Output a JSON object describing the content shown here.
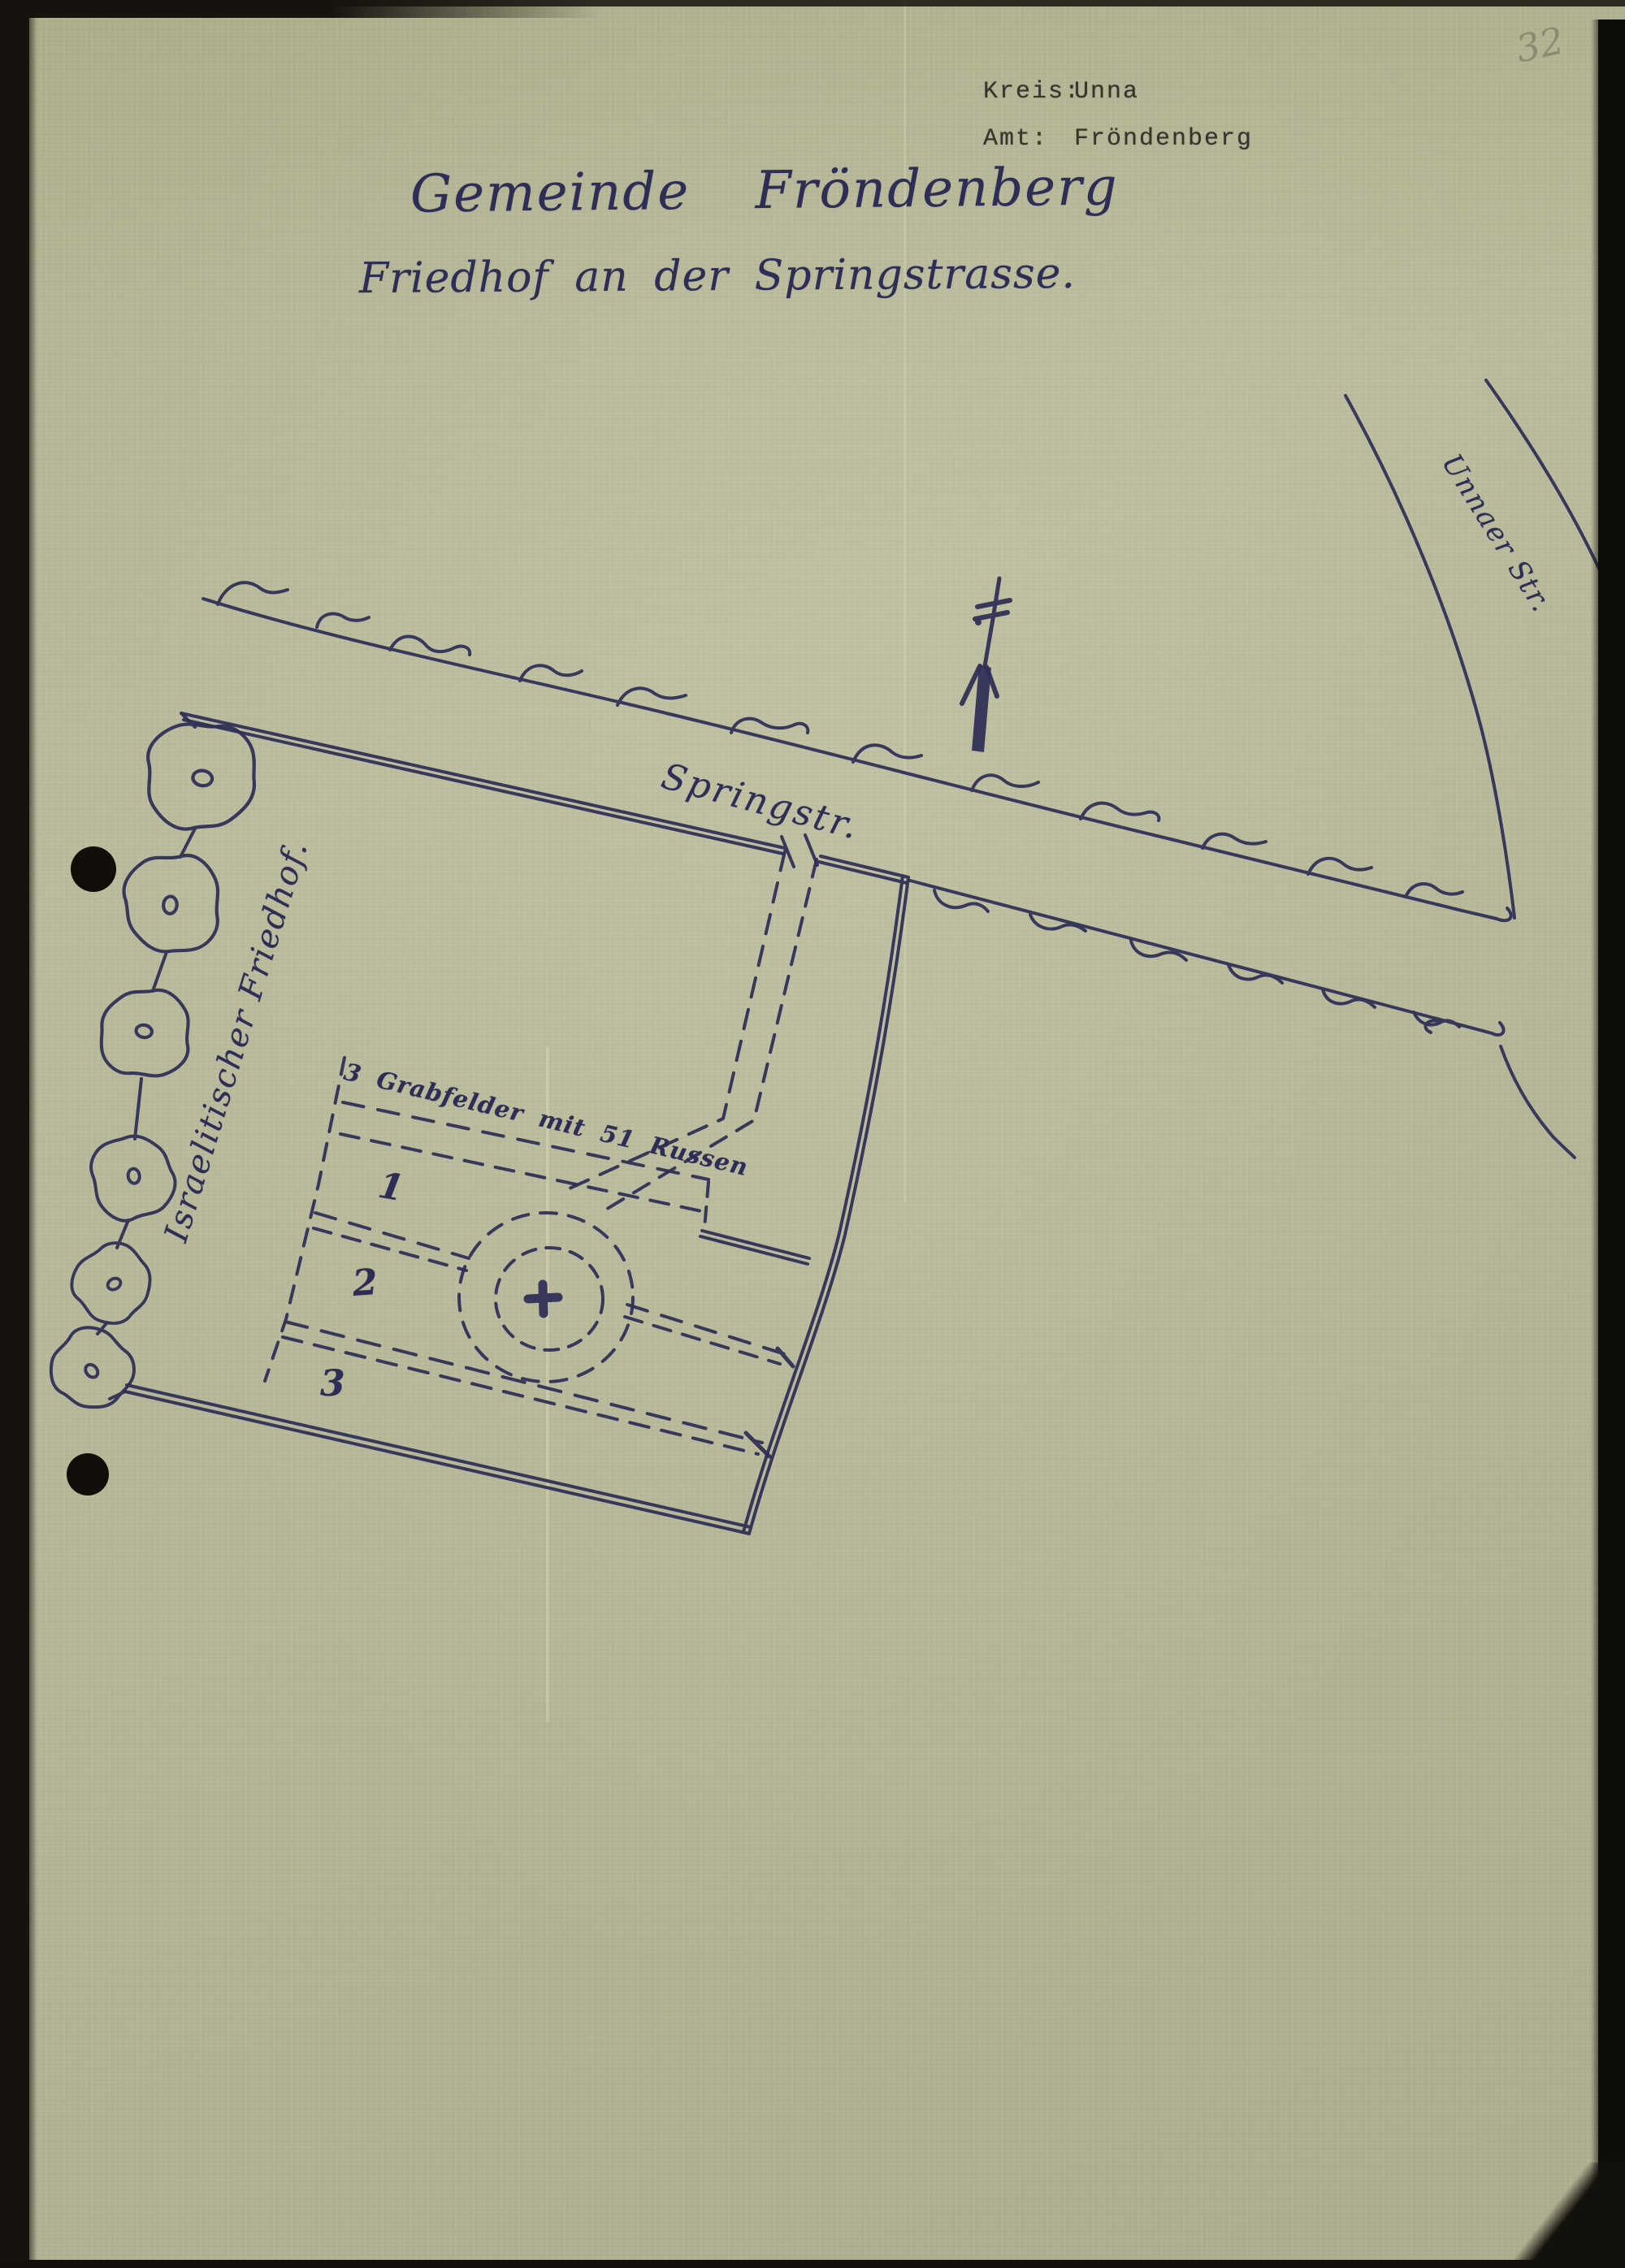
{
  "page": {
    "corner_number": "32",
    "header": {
      "rows": [
        {
          "label": "Kreis:",
          "value": "Unna"
        },
        {
          "label": "Amt:",
          "value": "Fröndenberg"
        }
      ]
    },
    "title": "Gemeinde Fröndenberg",
    "subtitle": "Friedhof an der Springstrasse.",
    "map": {
      "street_main": "Springstr.",
      "street_side": "Unnaer Str.",
      "cemetery_label": "Israelitischer Friedhof.",
      "grave_fields_note": "3 Grabfelder mit 51 Russen",
      "field_numbers": [
        "1",
        "2",
        "3"
      ]
    },
    "colors": {
      "paper": "#b5b697",
      "ink": "#2e2e56",
      "typewriter_ink": "#35352d",
      "pencil": "#7d7b63",
      "binding_edge": "#16130e"
    }
  }
}
